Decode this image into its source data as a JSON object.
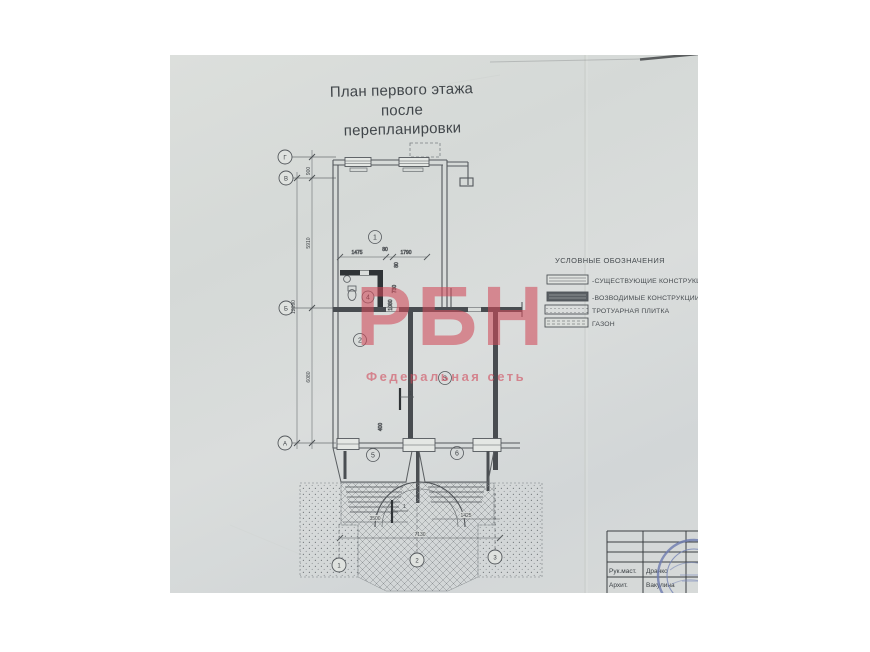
{
  "document": {
    "title_line1": "План первого этажа",
    "title_line2": "после перепланировки"
  },
  "watermark": {
    "text": "РБН",
    "subtitle": "Федеральная сеть",
    "color": "#d04a5a"
  },
  "legend": {
    "title": "УСЛОВНЫЕ ОБОЗНАЧЕНИЯ",
    "items": [
      {
        "label": "-СУЩЕСТВУЮЩИЕ КОНСТРУКЦИИ"
      },
      {
        "label": "-ВОЗВОДИМЫЕ КОНСТРУКЦИИ"
      },
      {
        "label": "ТРОТУАРНАЯ ПЛИТКА"
      },
      {
        "label": "ГАЗОН"
      }
    ]
  },
  "plan": {
    "room_numbers": [
      "1",
      "2",
      "3",
      "4",
      "5",
      "6"
    ],
    "axes_left": [
      "Г",
      "В",
      "Б",
      "А"
    ],
    "axes_bottom": [
      "1",
      "2",
      "3"
    ],
    "dimensions": {
      "v900": "900",
      "v5910": "5910",
      "v12090": "12090",
      "v6080": "6080",
      "h1475": "1475",
      "h80": "80",
      "h1790": "1790",
      "r80": "80",
      "r730": "730",
      "r1080": "1080",
      "r400": "400",
      "b3500": "3500",
      "b1425": "1425",
      "b7130": "7130"
    },
    "section_mark": "1"
  },
  "title_block": {
    "rows": [
      {
        "role": "Рук.маст.",
        "name": "Дранко"
      },
      {
        "role": "Архит.",
        "name": "Вакулина"
      }
    ]
  }
}
